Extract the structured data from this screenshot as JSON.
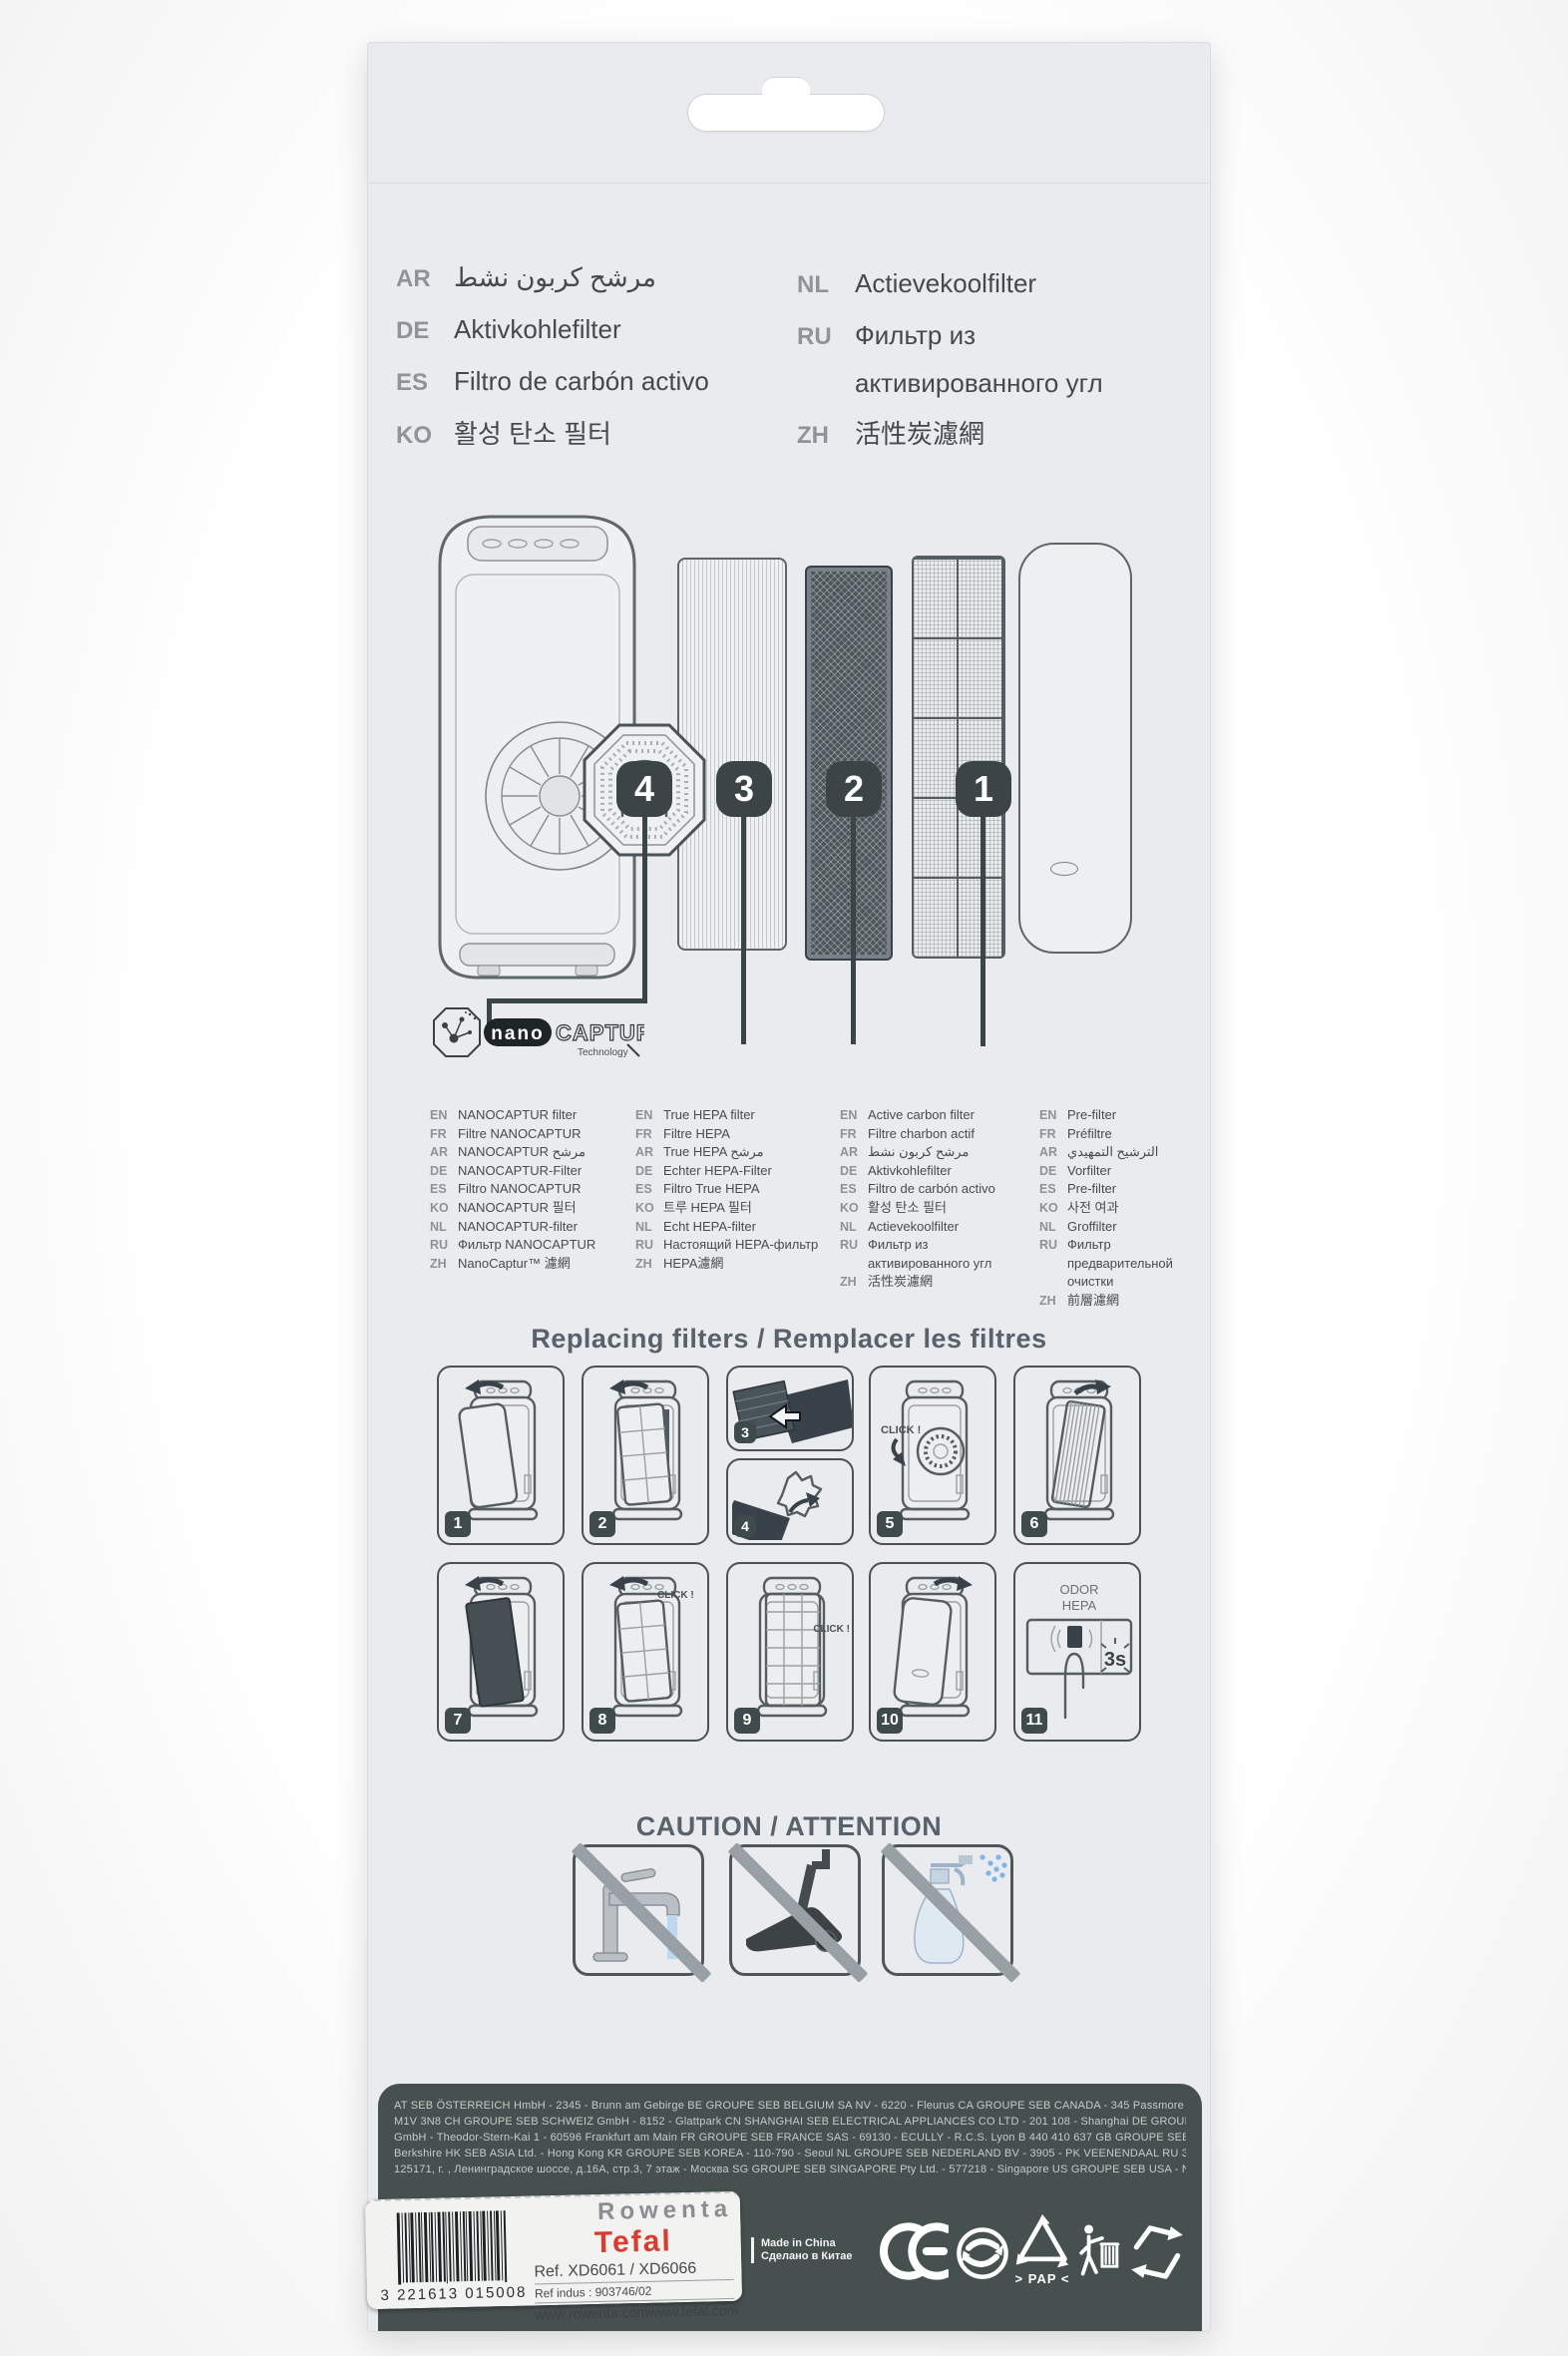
{
  "colors": {
    "tefal_red": "#dc3a2c",
    "slate_dark": "#3b4547",
    "package_bg": "#e9ebee",
    "band_bg": "#46514f"
  },
  "top_languages": {
    "left": [
      {
        "code": "AR",
        "text": "مرشح كربون نشط"
      },
      {
        "code": "DE",
        "text": "Aktivkohlefilter"
      },
      {
        "code": "ES",
        "text": "Filtro de carbón activo"
      },
      {
        "code": "KO",
        "text": "활성 탄소 필터"
      }
    ],
    "right": [
      {
        "code": "NL",
        "text": "Actievekoolfilter"
      },
      {
        "code": "RU",
        "text": "Фильтр из"
      },
      {
        "code": "",
        "text": "активированного угл"
      },
      {
        "code": "ZH",
        "text": "活性炭濾網"
      }
    ]
  },
  "diagram": {
    "badges": [
      "4",
      "3",
      "2",
      "1"
    ],
    "logo": {
      "nano": "nano",
      "captur": "CAPTUR",
      "technology": "Technology"
    }
  },
  "filter_columns": [
    {
      "name": "nanocaptur-filter",
      "rows": [
        {
          "code": "EN",
          "text": "NANOCAPTUR filter"
        },
        {
          "code": "FR",
          "text": "Filtre NANOCAPTUR"
        },
        {
          "code": "AR",
          "text": "NANOCAPTUR مرشح"
        },
        {
          "code": "DE",
          "text": "NANOCAPTUR-Filter"
        },
        {
          "code": "ES",
          "text": "Filtro NANOCAPTUR"
        },
        {
          "code": "KO",
          "text": "NANOCAPTUR 필터"
        },
        {
          "code": "NL",
          "text": "NANOCAPTUR-filter"
        },
        {
          "code": "RU",
          "text": "Фильтр NANOCAPTUR"
        },
        {
          "code": "ZH",
          "text": "NanoCaptur™ 濾網"
        }
      ]
    },
    {
      "name": "true-hepa-filter",
      "rows": [
        {
          "code": "EN",
          "text": "True HEPA filter"
        },
        {
          "code": "FR",
          "text": "Filtre HEPA"
        },
        {
          "code": "AR",
          "text": "True HEPA مرشح"
        },
        {
          "code": "DE",
          "text": "Echter HEPA-Filter"
        },
        {
          "code": "ES",
          "text": "Filtro True HEPA"
        },
        {
          "code": "KO",
          "text": "트루 HEPA 필터"
        },
        {
          "code": "NL",
          "text": "Echt HEPA-filter"
        },
        {
          "code": "RU",
          "text": "Настоящий HEPA-фильтр"
        },
        {
          "code": "ZH",
          "text": "HEPA濾網"
        }
      ]
    },
    {
      "name": "active-carbon-filter",
      "rows": [
        {
          "code": "EN",
          "text": "Active carbon filter"
        },
        {
          "code": "FR",
          "text": "Filtre charbon actif"
        },
        {
          "code": "AR",
          "text": "مرشح كربون نشط"
        },
        {
          "code": "DE",
          "text": "Aktivkohlefilter"
        },
        {
          "code": "ES",
          "text": "Filtro de carbón activo"
        },
        {
          "code": "KO",
          "text": "활성 탄소 필터"
        },
        {
          "code": "NL",
          "text": "Actievekoolfilter"
        },
        {
          "code": "RU",
          "text": "Фильтр из"
        },
        {
          "code": "",
          "text": "активированного угл"
        },
        {
          "code": "ZH",
          "text": "活性炭濾網"
        }
      ]
    },
    {
      "name": "pre-filter",
      "rows": [
        {
          "code": "EN",
          "text": "Pre-filter"
        },
        {
          "code": "FR",
          "text": "Préfiltre"
        },
        {
          "code": "AR",
          "text": "الترشيح التمهيدي"
        },
        {
          "code": "DE",
          "text": "Vorfilter"
        },
        {
          "code": "ES",
          "text": "Pre-filter"
        },
        {
          "code": "KO",
          "text": "사전 여과"
        },
        {
          "code": "NL",
          "text": "Groffilter"
        },
        {
          "code": "RU",
          "text": "Фильтр"
        },
        {
          "code": "",
          "text": "предварительной"
        },
        {
          "code": "",
          "text": "очистки"
        },
        {
          "code": "ZH",
          "text": "前層濾網"
        }
      ]
    }
  ],
  "replacing": {
    "heading": "Replacing filters / Remplacer les filtres"
  },
  "panels": {
    "numbers": [
      "1",
      "2",
      "3",
      "4",
      "5",
      "6",
      "7",
      "8",
      "9",
      "10",
      "11"
    ],
    "click_label": "CLICK !",
    "odor": "ODOR",
    "hepa": "HEPA",
    "hold_time": "3s"
  },
  "caution": {
    "heading": "CAUTION / ATTENTION"
  },
  "footer": {
    "lines": [
      "AT SEB ÖSTERREICH HmbH - 2345 - Brunn am Gebirge BE GROUPE SEB BELGIUM SA NV - 6220 - Fleurus CA GROUPE SEB CANADA - 345 Passmore Avenue, Toronto - ON",
      "M1V 3N8 CH GROUPE SEB SCHWEIZ GmbH - 8152 - Glattpark CN SHANGHAI SEB ELECTRICAL APPLIANCES CO LTD - 201 108 - Shanghai DE GROUPE SEB DEUTSCHLAND",
      "GmbH - Theodor-Stern-Kai 1 - 60596 Frankfurt am Main FR GROUPE SEB FRANCE SAS - 69130 - ECULLY - R.C.S. Lyon B 440 410 637 GB GROUPE SEB UK LTD. - SL4 1NA - Windsor",
      "Berkshire HK SEB ASIA Ltd. - Hong Kong KR GROUPE SEB KOREA - 110-790 - Seoul NL GROUPE SEB NEDERLAND BV - 3905 - PK VEENENDAAL RU ЗАО «Группа СЕБ-Восток» -",
      "125171, г. , Ленинградское шоссе, д.16А, стр.3, 7 этаж - Москва SG GROUPE SEB SINGAPORE Pty Ltd. - 577218 - Singapore US GROUPE SEB USA - NJ 08332 - Millville."
    ]
  },
  "label": {
    "barcode_digits": "3 221613 015008",
    "brand_rowenta": "Rowenta",
    "brand_tefal": "Tefal",
    "ref": "Ref. XD6061 / XD6066",
    "ref_indus": "Ref indus : 903746/02",
    "url_rowenta": "www.rowenta.com",
    "url_tefal": "www.tefal.com"
  },
  "made_in": {
    "line1": "Made in China",
    "line2": "Сделано в Китае"
  },
  "recycling": {
    "pap": "> PAP <"
  }
}
